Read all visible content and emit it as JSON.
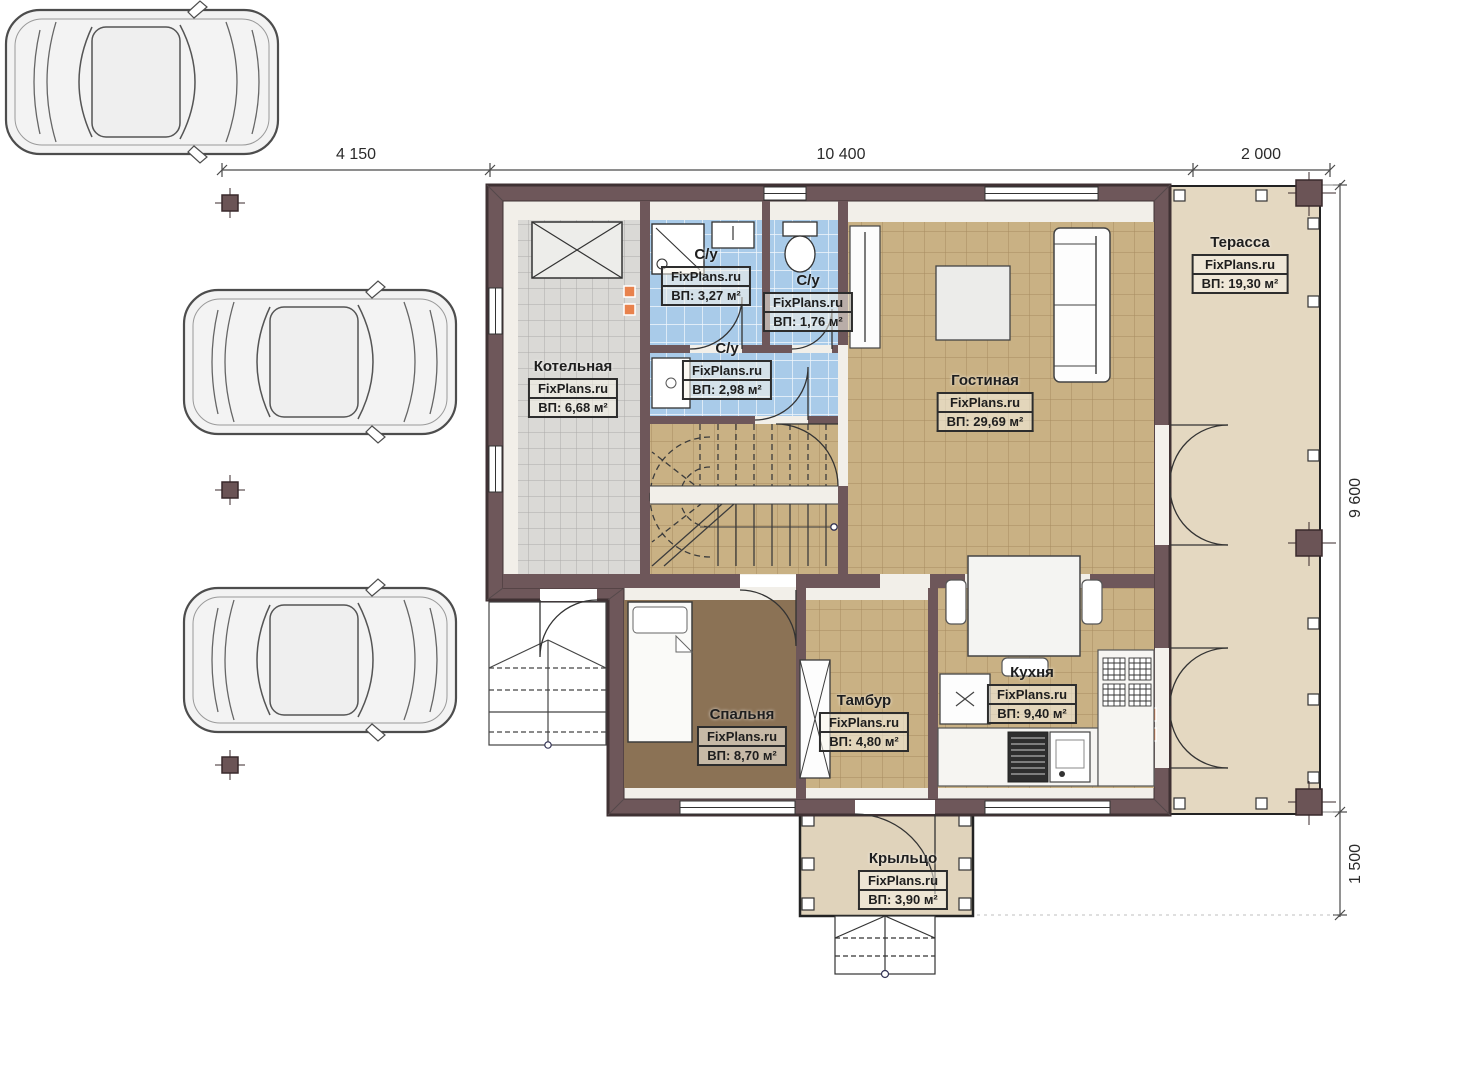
{
  "dimensions": {
    "top": [
      "4 150",
      "10 400",
      "2 000"
    ],
    "right": [
      "9 600",
      "1 500"
    ]
  },
  "rooms": [
    {
      "name": "Котельная",
      "brand": "FixPlans.ru",
      "area": "ВП: 6,68 м²"
    },
    {
      "name": "С/у",
      "brand": "FixPlans.ru",
      "area": "ВП: 3,27 м²"
    },
    {
      "name": "С/у",
      "brand": "FixPlans.ru",
      "area": "ВП: 1,76 м²"
    },
    {
      "name": "С/у",
      "brand": "FixPlans.ru",
      "area": "ВП: 2,98 м²"
    },
    {
      "name": "Гостиная",
      "brand": "FixPlans.ru",
      "area": "ВП: 29,69 м²"
    },
    {
      "name": "Терасса",
      "brand": "FixPlans.ru",
      "area": "ВП: 19,30 м²"
    },
    {
      "name": "Спальня",
      "brand": "FixPlans.ru",
      "area": "ВП: 8,70 м²"
    },
    {
      "name": "Тамбур",
      "brand": "FixPlans.ru",
      "area": "ВП: 4,80 м²"
    },
    {
      "name": "Кухня",
      "brand": "FixPlans.ru",
      "area": "ВП: 9,40 м²"
    },
    {
      "name": "Крыльцо",
      "brand": "FixPlans.ru",
      "area": "ВП: 3,90 м²"
    }
  ],
  "colors": {
    "wall": "#6e575a",
    "wall_outline": "#3f3133",
    "floor_tile_tan": "#c9b184",
    "floor_tile_blue": "#a9cbe9",
    "floor_tile_gray": "#dad9d6",
    "floor_bedroom": "#8b7255",
    "floor_terrace": "#e4d8c1",
    "floor_porch": "#e0d3bb",
    "interior_base": "#f2efe9",
    "vent_accent": "#e8824d"
  }
}
